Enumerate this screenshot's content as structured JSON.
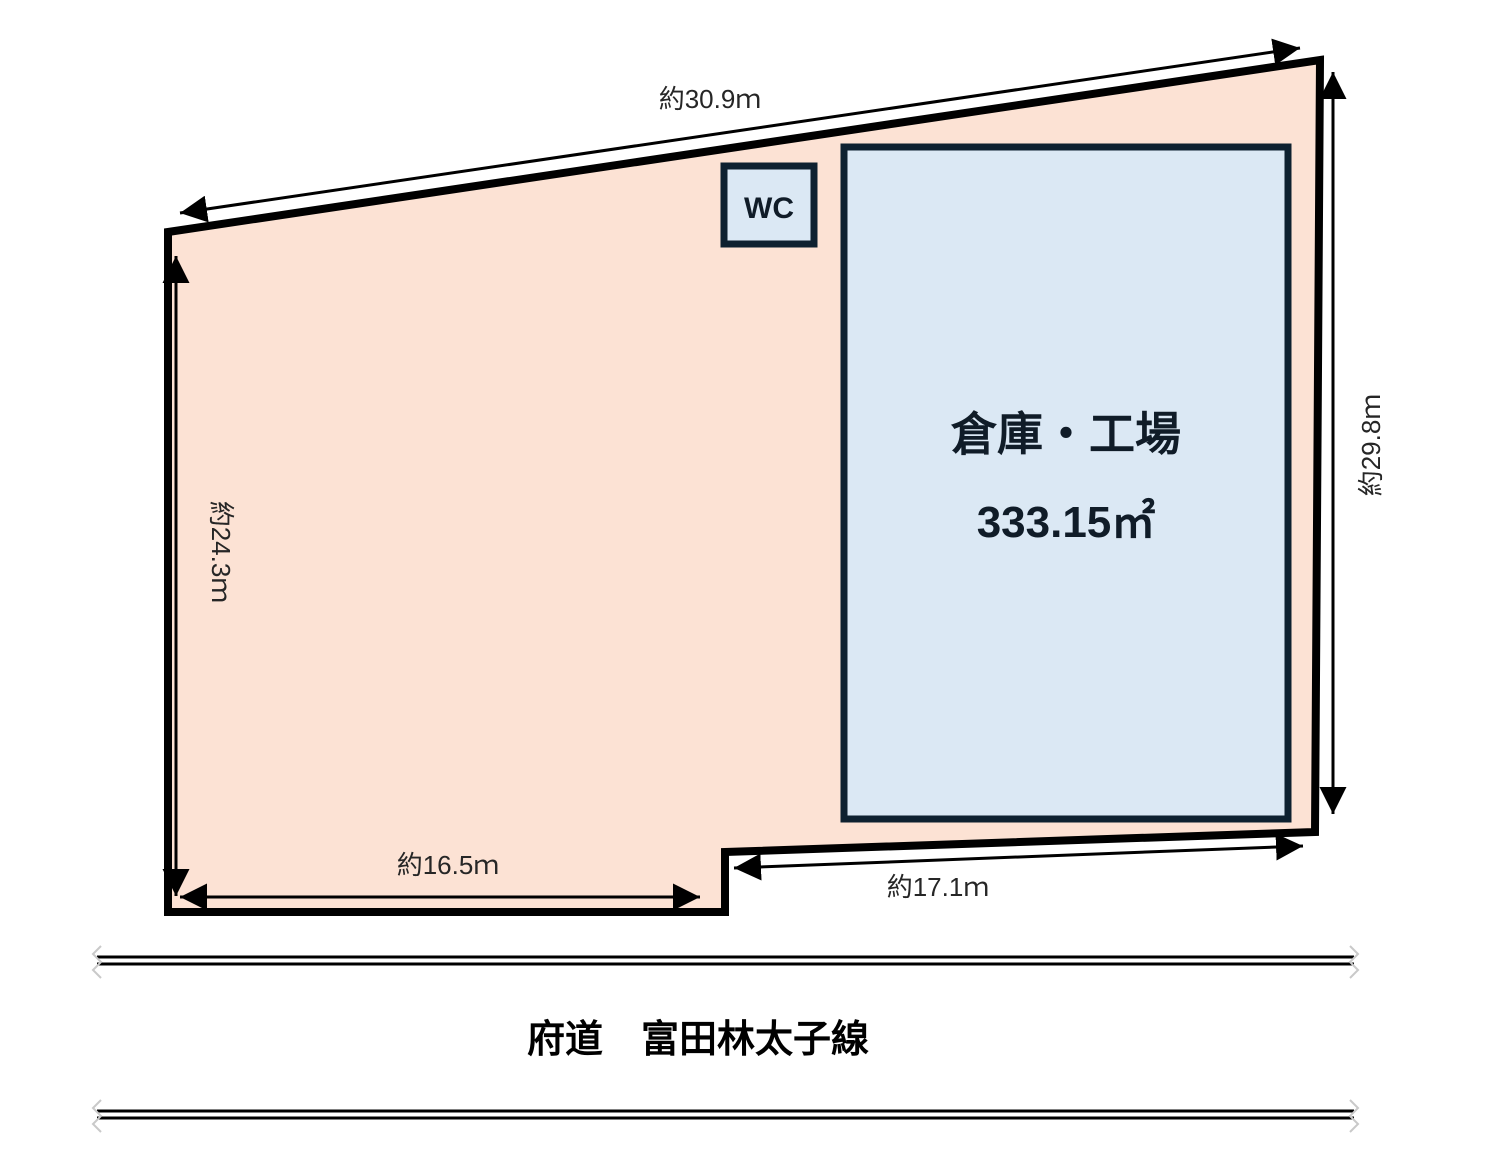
{
  "diagram": {
    "land": {
      "dimensions": {
        "top": "約30.9ｍ",
        "left": "約24.3ｍ",
        "right": "約29.8ｍ",
        "bottom_left": "約16.5ｍ",
        "bottom_right": "約17.1ｍ"
      }
    },
    "building": {
      "name": "倉庫・工場",
      "area": "333.15㎡"
    },
    "wc": {
      "label": "WC"
    },
    "road": {
      "name": "府道　富田林太子線"
    },
    "colors": {
      "land_fill": "#fce2d4",
      "building_fill": "#dbe8f4",
      "building_border": "#0e2130",
      "outline": "#000000",
      "dimension_text": "#262626",
      "building_text": "#101c28",
      "road_text": "#000000"
    }
  }
}
